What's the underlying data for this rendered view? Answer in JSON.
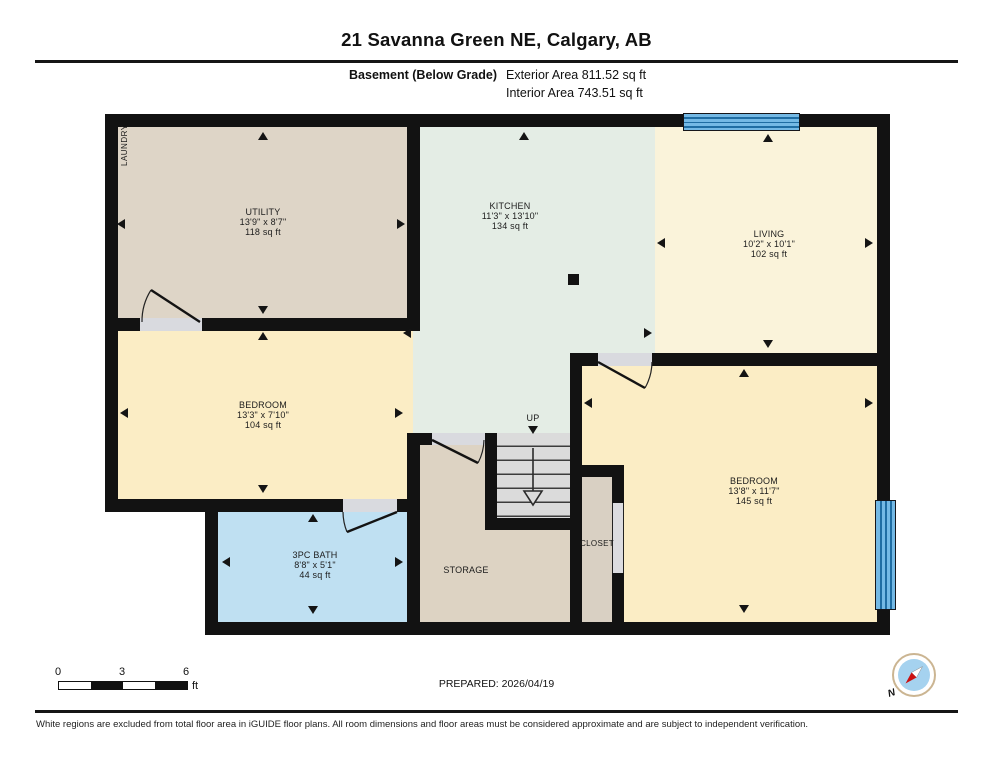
{
  "header": {
    "title": "21 Savanna Green NE, Calgary, AB",
    "floor_label": "Basement (Below Grade)",
    "exterior_area": "Exterior Area 811.52 sq ft",
    "interior_area": "Interior Area 743.51 sq ft"
  },
  "rooms": [
    {
      "name": "UTILITY",
      "dims": "13'9\" x 8'7\"",
      "area": "118 sq ft"
    },
    {
      "name": "KITCHEN",
      "dims": "11'3\" x 13'10\"",
      "area": "134 sq ft"
    },
    {
      "name": "LIVING",
      "dims": "10'2\" x 10'1\"",
      "area": "102 sq ft"
    },
    {
      "name": "BEDROOM",
      "dims": "13'3\" x 7'10\"",
      "area": "104 sq ft"
    },
    {
      "name": "BEDROOM",
      "dims": "13'8\" x 11'7\"",
      "area": "145 sq ft"
    },
    {
      "name": "3PC BATH",
      "dims": "8'8\" x 5'1\"",
      "area": "44 sq ft"
    }
  ],
  "labels": {
    "laundry": "LAUNDRY",
    "storage": "STORAGE",
    "closet": "CLOSET",
    "up": "UP"
  },
  "scale_bar": {
    "ticks": [
      "0",
      "3",
      "6"
    ],
    "unit": "ft"
  },
  "footer": {
    "prepared": "PREPARED: 2026/04/19",
    "compass_n": "N",
    "disclaimer": "White regions are excluded from total floor area in iGUIDE floor plans. All room dimensions and floor areas must be considered approximate and are subject to independent verification."
  },
  "palette": {
    "wall": "#121212",
    "utility": "#ded5c7",
    "kitchen": "#e4ede5",
    "living": "#faf3da",
    "bedroom": "#fbedc5",
    "bath": "#bfe0f2",
    "storage": "#ddd3c3",
    "closet": "#d9d0c3",
    "window_blue": "#74b9e5",
    "stairs": "#dbdbdb"
  }
}
